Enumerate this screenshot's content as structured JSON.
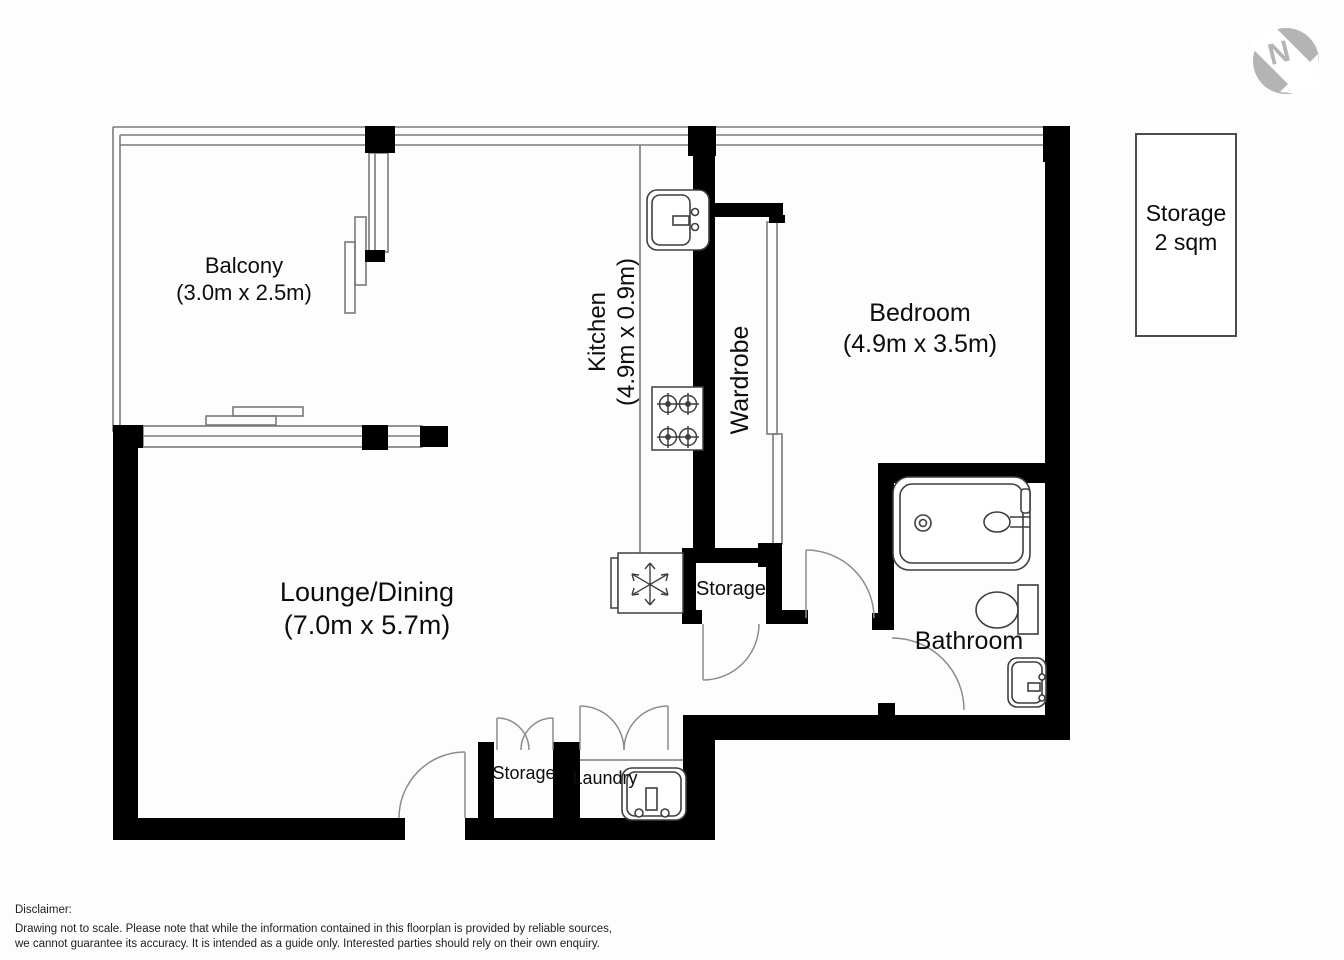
{
  "rooms": {
    "balcony": {
      "name": "Balcony",
      "dims": "(3.0m x 2.5m)"
    },
    "lounge": {
      "name": "Lounge/Dining",
      "dims": "(7.0m x 5.7m)"
    },
    "kitchen": {
      "name": "Kitchen",
      "dims": "(4.9m x 0.9m)"
    },
    "wardrobe": {
      "name": "Wardrobe"
    },
    "bedroom": {
      "name": "Bedroom",
      "dims": "(4.9m x 3.5m)"
    },
    "bathroom": {
      "name": "Bathroom"
    },
    "storage_hall": {
      "name": "Storage"
    },
    "storage_entry": {
      "name": "Storage"
    },
    "laundry": {
      "name": "Laundry"
    }
  },
  "storage_unit": {
    "label": "Storage",
    "area": "2 sqm"
  },
  "compass": {
    "label": "N"
  },
  "disclaimer": {
    "heading": "Disclaimer:",
    "line1": "Drawing not to scale. Please note that while the information contained in this floorplan is provided by reliable sources,",
    "line2": "we cannot guarantee its accuracy. It is intended as a guide only. Interested parties should rely on their own enquiry."
  },
  "colors": {
    "wall": "#000000",
    "window_line": "#7b7b7b",
    "door_arc": "#8c8c8c",
    "fixture": "#3f3f3f",
    "compass_gray": "#b4b4b4"
  }
}
